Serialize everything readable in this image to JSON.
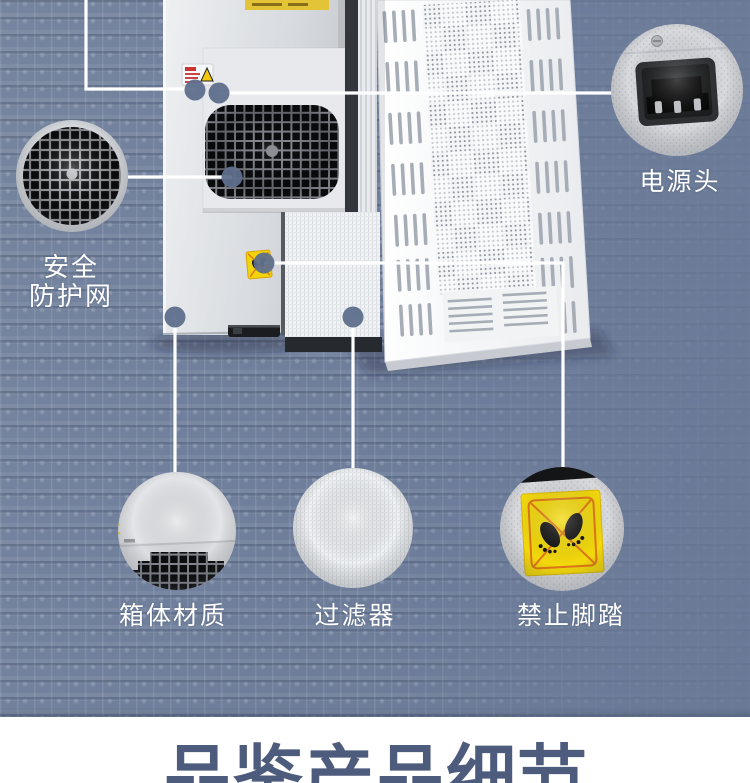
{
  "banner": {
    "title": "品鉴产品细节",
    "text_color": "#4d5c7c",
    "background": "#ffffff"
  },
  "callouts": {
    "safety_net": {
      "label": "安全防护网",
      "line1": "安全",
      "line2": "防护网"
    },
    "power_plug": {
      "label": "电源头"
    },
    "box_material": {
      "label": "箱体材质"
    },
    "filter": {
      "label": "过滤器"
    },
    "no_step": {
      "label": "禁止脚踏"
    }
  },
  "icons": {
    "fan_grille": "black square-grid fan guard",
    "power_socket": "black IEC inlet socket with 3 pins",
    "no_step_sign": "yellow sign, two black footprints crossed out",
    "warning_label": "small white sticker with red text and yellow warning triangle",
    "lightning_label": "tiny yellow lightning sticker"
  },
  "colors": {
    "background": "#6e7e9b",
    "callout_line": "#ffffff",
    "anchor_dot": "#5f6f8d",
    "warning_yellow": "#f3d90c",
    "banner_text": "#4d5c7c"
  }
}
